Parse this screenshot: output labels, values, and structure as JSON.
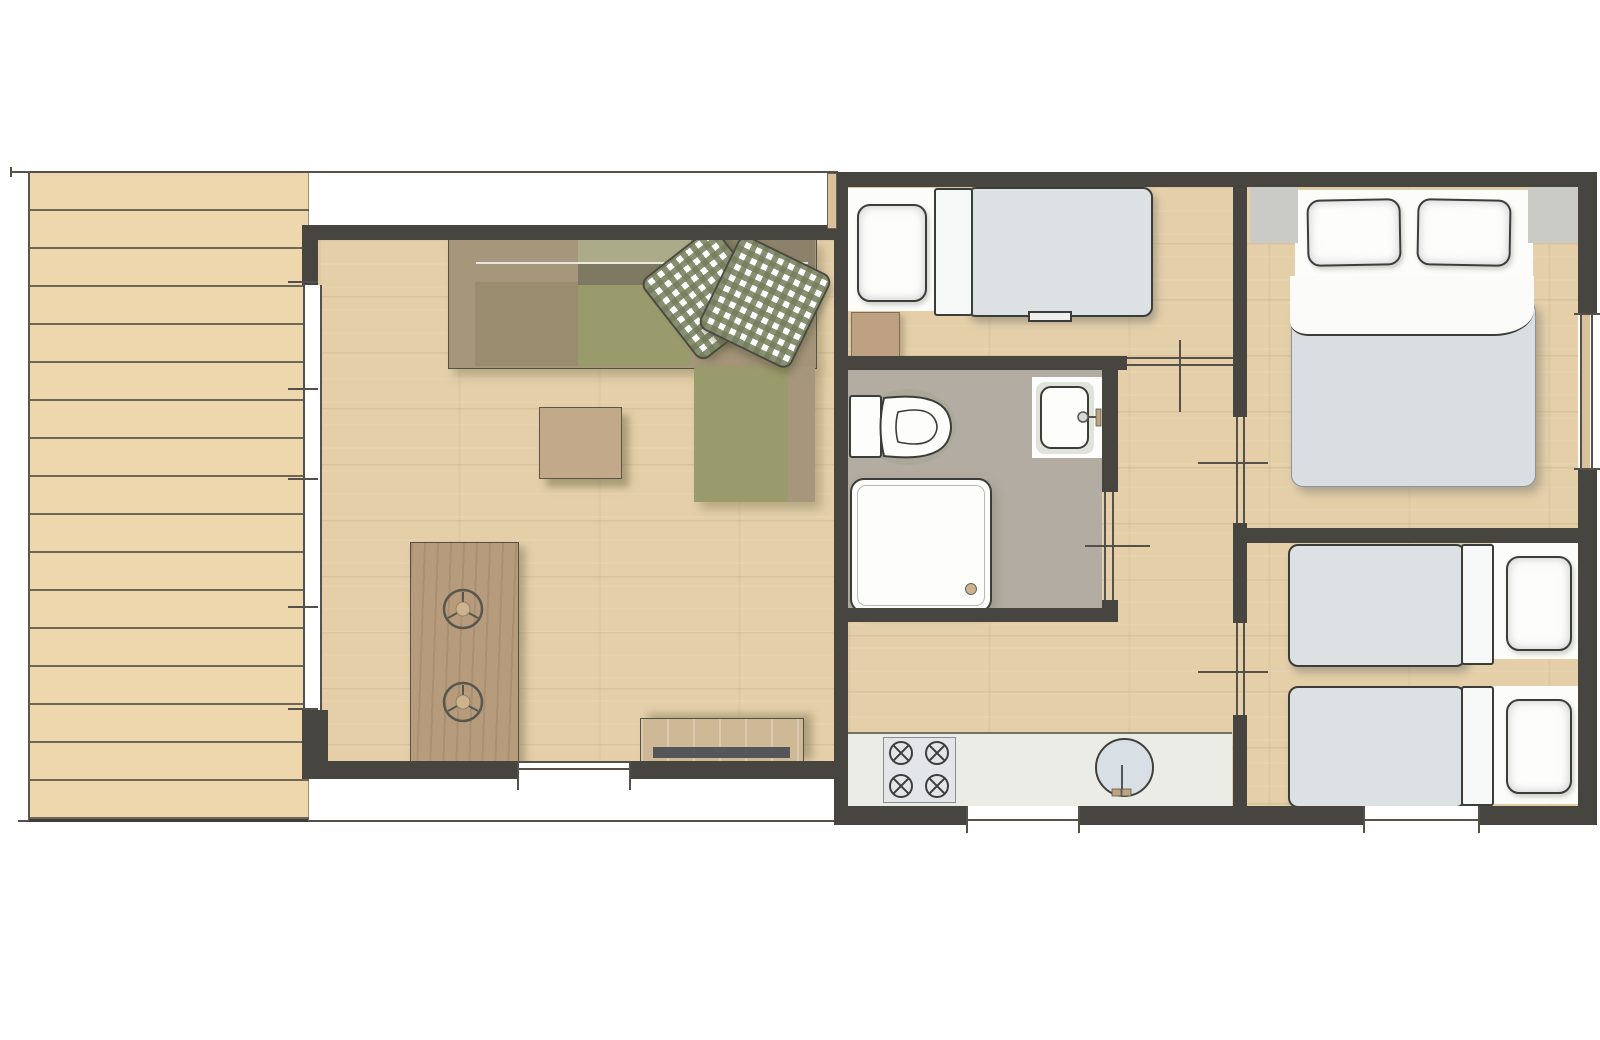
{
  "document": {
    "kind": "floor-plan",
    "subject": "mobile-home / holiday chalet top-view plan",
    "canvas": {
      "width": 1600,
      "height": 1040
    },
    "has_text_labels": false
  },
  "colors": {
    "wall": "#474540",
    "line": "#55514a",
    "outline_dark": "#3c3c38",
    "deck": "#eed7ad",
    "deck_line": "#6e6656",
    "floor": "#e4cfa9",
    "bath_floor": "#b3aca2",
    "counter": "#ececE7",
    "appliance": "#e2e6e9",
    "water": "#d8e0e6",
    "mattress": "#dce1e4",
    "duvet": "#d8dee1",
    "sheet": "#fcfcfa",
    "sofa_frame": "#a5967c",
    "sofa_cushion_tan": "#9a8c6f",
    "sofa_back_sage": "#abab8a",
    "sofa_back_dark": "#7e7960",
    "sofa_olive": "#9a9b6d",
    "gingham": "#737c5a",
    "table_wood": "#b69c7d",
    "chair_teal": "#7e8d82",
    "chair_teal_stripe": "#5d6f64",
    "chair_orange": "#bf7a49",
    "chair_orange_stripe": "#96572f",
    "tv_wood": "#cfb896",
    "tv_screen": "#54565a",
    "ottoman": "#c2a98a",
    "nightstand": "#bda182",
    "pad_gray": "#cacac6",
    "window_wood": "#d9c29a"
  },
  "rooms": [
    {
      "id": "terrace",
      "name": "terrace-deck",
      "features": [
        {
          "item": "plank-decking",
          "count": 1
        }
      ]
    },
    {
      "id": "living-room",
      "name": "living-room",
      "furniture": [
        {
          "item": "corner-sofa",
          "count": 1
        },
        {
          "item": "gingham-cushion",
          "count": 2
        },
        {
          "item": "ottoman-side-table",
          "count": 1
        },
        {
          "item": "dining-table",
          "count": 1
        },
        {
          "item": "dining-chair-teal",
          "count": 3
        },
        {
          "item": "dining-chair-orange",
          "count": 3
        },
        {
          "item": "serving-tray",
          "count": 2
        },
        {
          "item": "tv-sideboard",
          "count": 1
        }
      ],
      "openings": [
        {
          "item": "window-band-left",
          "count": 1
        },
        {
          "item": "sliding-door-bottom",
          "count": 1
        }
      ]
    },
    {
      "id": "bedroom-single",
      "name": "bedroom-single",
      "furniture": [
        {
          "item": "single-bed",
          "count": 1
        },
        {
          "item": "pillow",
          "count": 1
        },
        {
          "item": "nightstand",
          "count": 1
        }
      ]
    },
    {
      "id": "bathroom",
      "name": "bathroom",
      "fixtures": [
        {
          "item": "toilet",
          "count": 1
        },
        {
          "item": "washbasin",
          "count": 1
        },
        {
          "item": "shower-tray",
          "count": 1
        }
      ]
    },
    {
      "id": "hallway",
      "name": "hallway",
      "openings": [
        {
          "item": "door-bedroom-single",
          "count": 1
        },
        {
          "item": "door-bedroom-master",
          "count": 1
        },
        {
          "item": "door-bedroom-twin",
          "count": 1
        },
        {
          "item": "door-bathroom",
          "count": 1
        }
      ]
    },
    {
      "id": "kitchen",
      "name": "kitchenette",
      "fixtures": [
        {
          "item": "worktop",
          "count": 1
        },
        {
          "item": "hob-burner",
          "count": 4
        },
        {
          "item": "round-sink",
          "count": 1
        },
        {
          "item": "window",
          "count": 1
        }
      ]
    },
    {
      "id": "bedroom-master",
      "name": "bedroom-master",
      "furniture": [
        {
          "item": "double-bed",
          "count": 1
        },
        {
          "item": "pillow",
          "count": 2
        },
        {
          "item": "bedside-pad",
          "count": 2
        },
        {
          "item": "window",
          "count": 1
        }
      ]
    },
    {
      "id": "bedroom-twin",
      "name": "bedroom-twin",
      "furniture": [
        {
          "item": "single-bed",
          "count": 2
        },
        {
          "item": "pillow",
          "count": 2
        },
        {
          "item": "window",
          "count": 1
        }
      ]
    }
  ]
}
